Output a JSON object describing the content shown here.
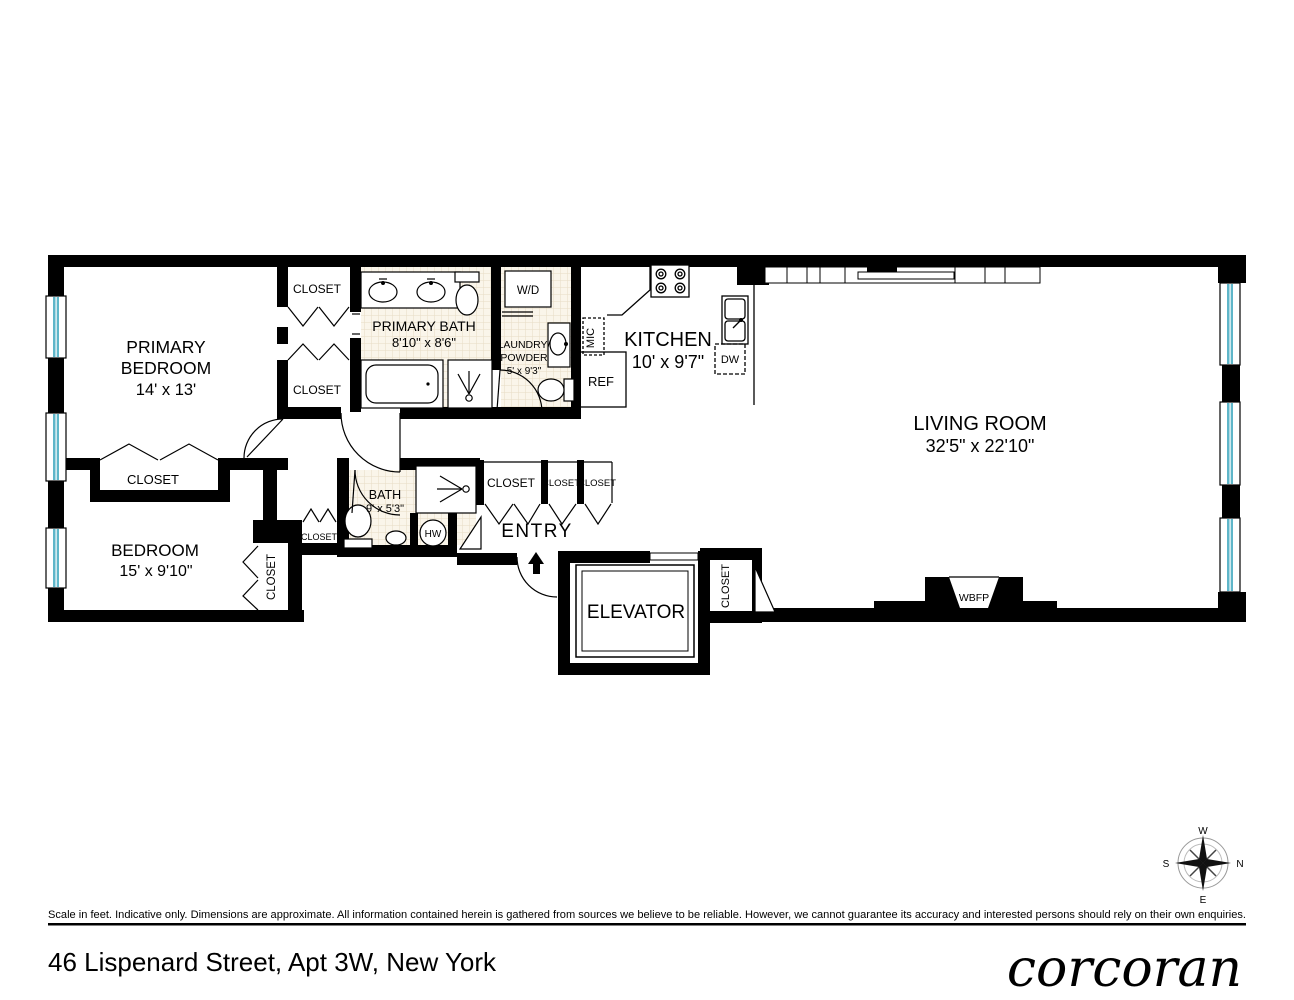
{
  "page": {
    "disclaimer": "Scale in feet. Indicative only. Dimensions are approximate. All information contained herein is gathered from sources we believe to be reliable. However, we cannot guarantee its accuracy and interested persons should rely on their own enquiries.",
    "address": "46 Lispenard Street, Apt 3W, New York",
    "brand": "corcoran"
  },
  "rooms": {
    "primary_bedroom": {
      "line1": "PRIMARY",
      "line2": "BEDROOM",
      "dims": "14' x 13'"
    },
    "bedroom": {
      "line1": "BEDROOM",
      "dims": "15' x 9'10\""
    },
    "primary_bath": {
      "line1": "PRIMARY BATH",
      "dims": "8'10\" x 8'6\""
    },
    "bath": {
      "line1": "BATH",
      "dims": "9' x 5'3\""
    },
    "laundry_powder": {
      "line1": "LAUNDRY/",
      "line2": "POWDER",
      "dims": "5' x 9'3\""
    },
    "kitchen": {
      "line1": "KITCHEN",
      "dims": "10' x 9'7\""
    },
    "living_room": {
      "line1": "LIVING ROOM",
      "dims": "32'5\" x 22'10\""
    },
    "entry": {
      "line1": "ENTRY"
    },
    "elevator": {
      "line1": "ELEVATOR"
    }
  },
  "labels": {
    "closet": "CLOSET",
    "wd": "W/D",
    "mic": "MIC",
    "ref": "REF",
    "dw": "DW",
    "hw": "HW",
    "wbfp": "WBFP"
  },
  "compass": {
    "n": "N",
    "s": "S",
    "e": "E",
    "w": "W"
  },
  "colors": {
    "wall": "#000000",
    "window_glass": "#5FB6C9",
    "tile_bg": "#FAF5EA",
    "tile_line": "#E7DCC4"
  }
}
